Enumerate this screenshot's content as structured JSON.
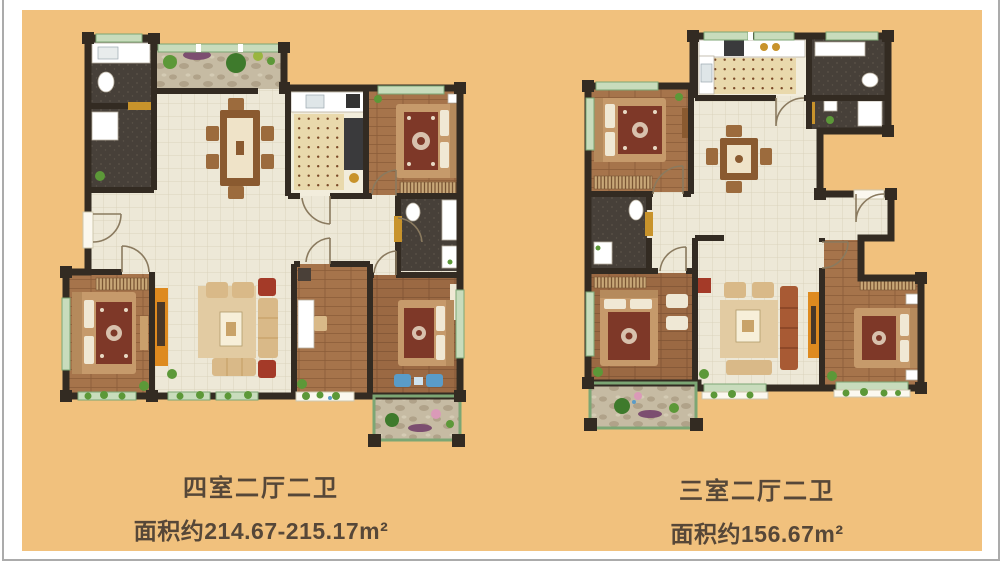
{
  "page": {
    "type": "real-estate floor plan sheet",
    "plan_count": 2
  },
  "plans": {
    "left": {
      "title": "四室二厅二卫",
      "area_label": "面积约214.67-215.17m²"
    },
    "right": {
      "title": "三室二厅二卫",
      "area_label": "面积约156.67m²"
    }
  },
  "palette": {
    "outer": "#FFFFFF",
    "frame": "#ABABAB",
    "bg": "#F1C17D",
    "text": "#564738",
    "wall": "#332B22",
    "tile": "#EDE8D7",
    "tileline": "#DAD3BC",
    "wood": "#A6744B",
    "woodline": "#8A5C38",
    "wood2": "#9B6943",
    "wood2line": "#7F5434",
    "darkfloor": "#474039",
    "darkspeck": "#5C5349",
    "stone": "#C6BBA3",
    "stoneblob": "#B0A289",
    "stoneblob2": "#D4CBB4",
    "kfloor": "#F2EDDC",
    "mat": "#E9D9AC",
    "dot": "#7B4A28",
    "wingreen": "#C8DCBC",
    "winframe": "#7CA674",
    "sill": "#FBF8EF",
    "plant": "#5C9838",
    "plantdark": "#3E7A2C",
    "purple": "#7C4E70",
    "pink": "#DA9AB8",
    "bedrug": "#7E3828",
    "rugpat": "#E8D9C4",
    "bedframe": "#C69A6B",
    "headboard": "#B58A5C",
    "pillow": "#F0E8D4",
    "sofa": "#D9B988",
    "sofadark": "#C7A269",
    "rugtan": "#E2CBA2",
    "tablewood": "#8A5A30",
    "chairwood": "#9C6B3D",
    "coffee": "#F7EFD9",
    "orange": "#DE8A1F",
    "gold": "#C8932B",
    "redchair": "#A43A28",
    "redsofa": "#A85A34",
    "blue": "#5A9CC8",
    "stove": "#3A3A3C",
    "white": "#FFFFFF",
    "counter": "#FAFAF4"
  }
}
